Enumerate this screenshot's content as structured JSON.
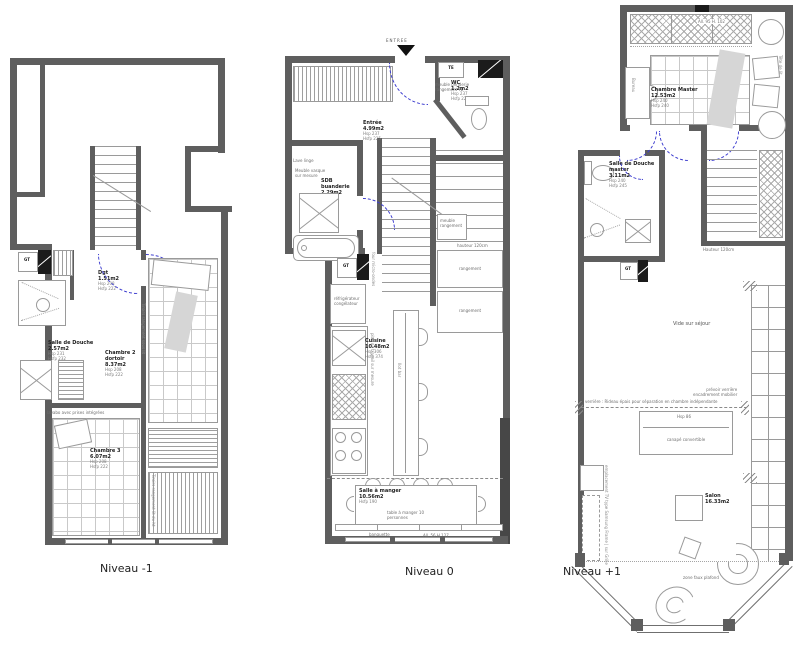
{
  "captions": {
    "m1": "Niveau -1",
    "n0": "Niveau 0",
    "p1": "Niveau +1"
  },
  "m1": {
    "gt": "GT",
    "dgt": {
      "n": "Dgt",
      "a": "1.51m2",
      "h1": "Hsp 208",
      "h2": "Hsfp 222"
    },
    "sdd": {
      "n": "Salle de Douche",
      "a": "2.57m2",
      "h1": "Hsp 231",
      "h2": "Hsfp 232"
    },
    "c2": {
      "n": "Chambre 2",
      "n2": "dortoir",
      "a": "8.37m2",
      "h1": "Hsp 208",
      "h2": "Hsfp 222"
    },
    "c3": {
      "n": "Chambre 3",
      "a": "6.07m2",
      "h1": "Hsp 208",
      "h2": "Hsfp 222"
    },
    "lavabo": "lavabo avec prises intégrées",
    "tiroirs1": "Tiroirs rangement sous lit",
    "tiroirs2": "Tiroirs rangement lit du ht"
  },
  "n0": {
    "entree_arrow": "ENTREE",
    "te": "TE",
    "gt": "GT",
    "entree": {
      "n": "Entrée",
      "a": "4.99m2",
      "h1": "Hsp 237",
      "h2": "Hsfp 225"
    },
    "wc": {
      "n": "WC",
      "a": "1.2m2",
      "h1": "Hsp 237",
      "h2": "Hsfp 225"
    },
    "sdb": {
      "n": "SDB",
      "n2": "buanderie",
      "a": "2.29m2",
      "h1": "Hsp 237",
      "h2": "Hsfp 227"
    },
    "cuisine": {
      "n": "Cuisine",
      "a": "10.48m2",
      "h1": "Hsp 306",
      "h2": "Hsfp 374"
    },
    "sam": {
      "n": "Salle à manger",
      "a": "10.56m2",
      "h1": "Hsfp 190"
    },
    "lavelinge": "Lave linge",
    "vasque1": "Meuble vasque",
    "vasque2": "sur mesure",
    "penderie1": "meuble penderie",
    "penderie2": "rangement TE",
    "frigo1": "réfrigérateur",
    "frigo2": "congélateur",
    "four": "four micro-ondes",
    "plan_travail": "plan de travail sur mesure",
    "ilot": "Ilot bar",
    "rangement": "rangement",
    "hauteur": "hauteur 120cm",
    "meuble_rgt1": "meuble",
    "meuble_rgt2": "rangement",
    "table1": "table à manger 10",
    "table2": "personnes",
    "banquette": "banquette",
    "allege": "All. 56 H 127"
  },
  "p1": {
    "gt": "GT",
    "master": {
      "n": "Chambre Master",
      "a": "12.53m2",
      "h1": "Hsp 240",
      "h2": "Hsfp 240"
    },
    "sdm": {
      "n": "Salle de Douche",
      "n2": "master",
      "a": "3.11m2",
      "h1": "Hsp 240",
      "h2": "Hsfp 245"
    },
    "salon": {
      "n": "Salon",
      "a": "16.33m2"
    },
    "allege": "All. 95 H. 102",
    "bureau": "Bureau",
    "tete": "Tête de lit",
    "hauteur": "Hauteur 120cm",
    "vide": "Vide sur séjour",
    "note1": "prévoir verrière",
    "note2": "encadrement mobilier",
    "rideau": "verrière : Rideau épais pour séparation en chambre indépendante",
    "hsp_canape": "Hsp 86",
    "canape": "canapé convertible",
    "tv": "emplacement TV type Samsung Frame | sur Grille",
    "fauxplafond": "zone faux plafond"
  }
}
